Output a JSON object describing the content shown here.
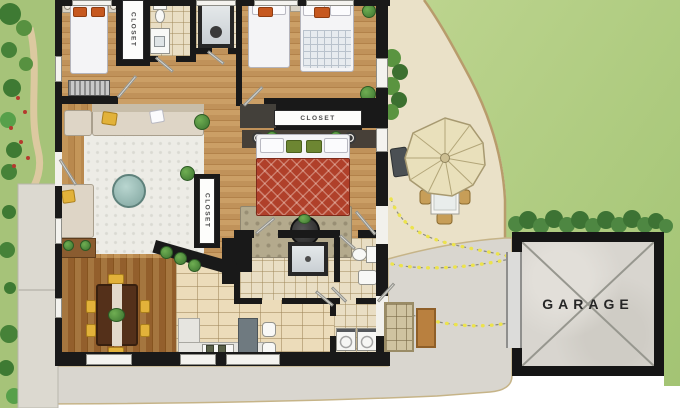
{
  "labels": {
    "closet_hall": "CLOSET",
    "closet_master": "CLOSET",
    "closet_living": "CLOSET",
    "garage": "GARAGE"
  },
  "palette": {
    "wall": "#191919",
    "lawn": "#aecb80",
    "hedge": "#4e8742",
    "patio": "#eae1c8",
    "curb": "#b89c6c",
    "driveway": "#d9d6cf",
    "garden": "#a6c379",
    "walkway": "#dcd9d0",
    "wood_floor": "#c49760",
    "dining_floor": "#9c6d38",
    "tile": "#ecdcba",
    "rug_living": "#edece6",
    "rug_master": "#b4aa8d",
    "bed_red": "#b0402a",
    "pillow_orange": "#c6581f",
    "chair_yellow": "#dfa832",
    "dining_table": "#54301a",
    "trail_yellow": "#ece34d",
    "garage_floor": "#d8d5cf",
    "plant_green": "#4e8a3c"
  }
}
